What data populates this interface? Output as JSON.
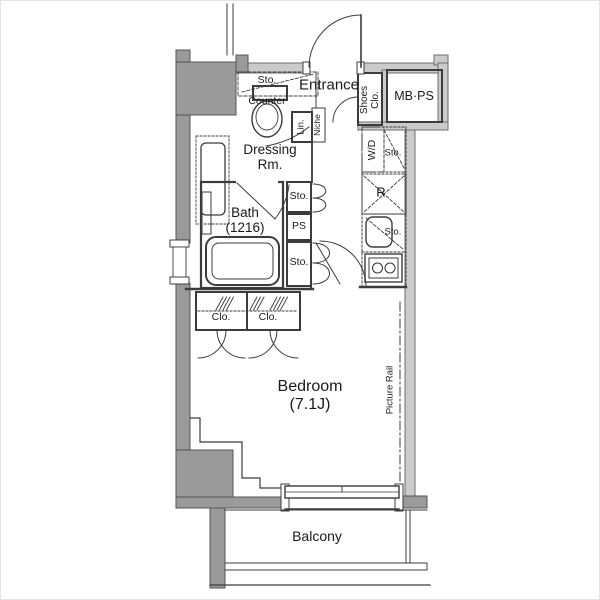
{
  "labels": {
    "storage_toilet": "Sto.",
    "counter": "Counter",
    "entrance": "Entrance",
    "niche": "Niche",
    "linen": "Lin.",
    "shoes_closet": "Shoes\nClo.",
    "mb_ps": "MB·PS",
    "dressing_room": "Dressing\nRm.",
    "washer_dryer": "W/D",
    "storage_kitchen_upper": "Sto.",
    "refrigerator": "R",
    "storage_kitchen_lower": "Sto.",
    "bath": "Bath\n(1216)",
    "storage_hall_upper": "Sto.",
    "pipe_space": "PS",
    "storage_hall_lower": "Sto.",
    "closet_left": "Clo.",
    "closet_right": "Clo.",
    "bedroom": "Bedroom\n(7.1J)",
    "picture_rail": "Picture Rail",
    "balcony": "Balcony"
  },
  "colors": {
    "wall_dark": "#9a9a9a",
    "wall_light": "#cbcbcb",
    "line": "#3c3c3c",
    "text": "#1a1a1a",
    "background": "#ffffff"
  }
}
